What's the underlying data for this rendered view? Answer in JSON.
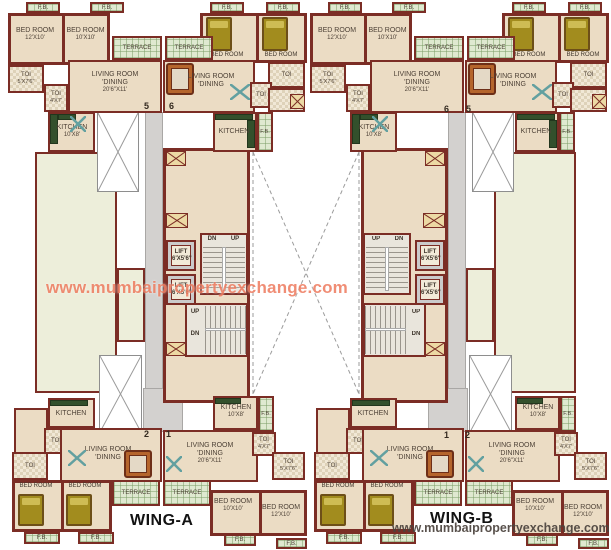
{
  "labels": {
    "fb": "F.B.",
    "terrace": "TERRACE",
    "bedroom": "BED ROOM",
    "living1": "LIVING ROOM",
    "living2": "'DINING",
    "kitchen": "KITCHEN",
    "toi": "TOI",
    "lift": "LIFT",
    "up": "UP",
    "dn": "DN"
  },
  "dims": {
    "bed_large": "12'X10'",
    "bed_small": "10'X10'",
    "living": "20'6\"X11'",
    "kitchen": "10'X8'",
    "toi_large": "5'X7'6\"",
    "toi_small": "4'X7'",
    "lift": "6'X5'6\""
  },
  "unit_numbers": {
    "wing_a": {
      "top_left": "5",
      "top_right": "6",
      "bottom_left": "2",
      "bottom_right": "1"
    },
    "wing_b": {
      "top_left": "6",
      "top_right": "5",
      "bottom_left": "1",
      "bottom_right": "2"
    }
  },
  "wing_titles": {
    "a": "WING-A",
    "b": "WING-B"
  },
  "watermarks": {
    "center": "www.mumbaipropertyexchange.com",
    "bottom": "www.mumbaipropertyexchange.com"
  },
  "colors": {
    "wall": "#7b2d25",
    "floor": "#ebdcc4",
    "terrace_green": "#dfe9d0",
    "pale_area": "#edeeda",
    "watermark": "#ee7e62"
  }
}
